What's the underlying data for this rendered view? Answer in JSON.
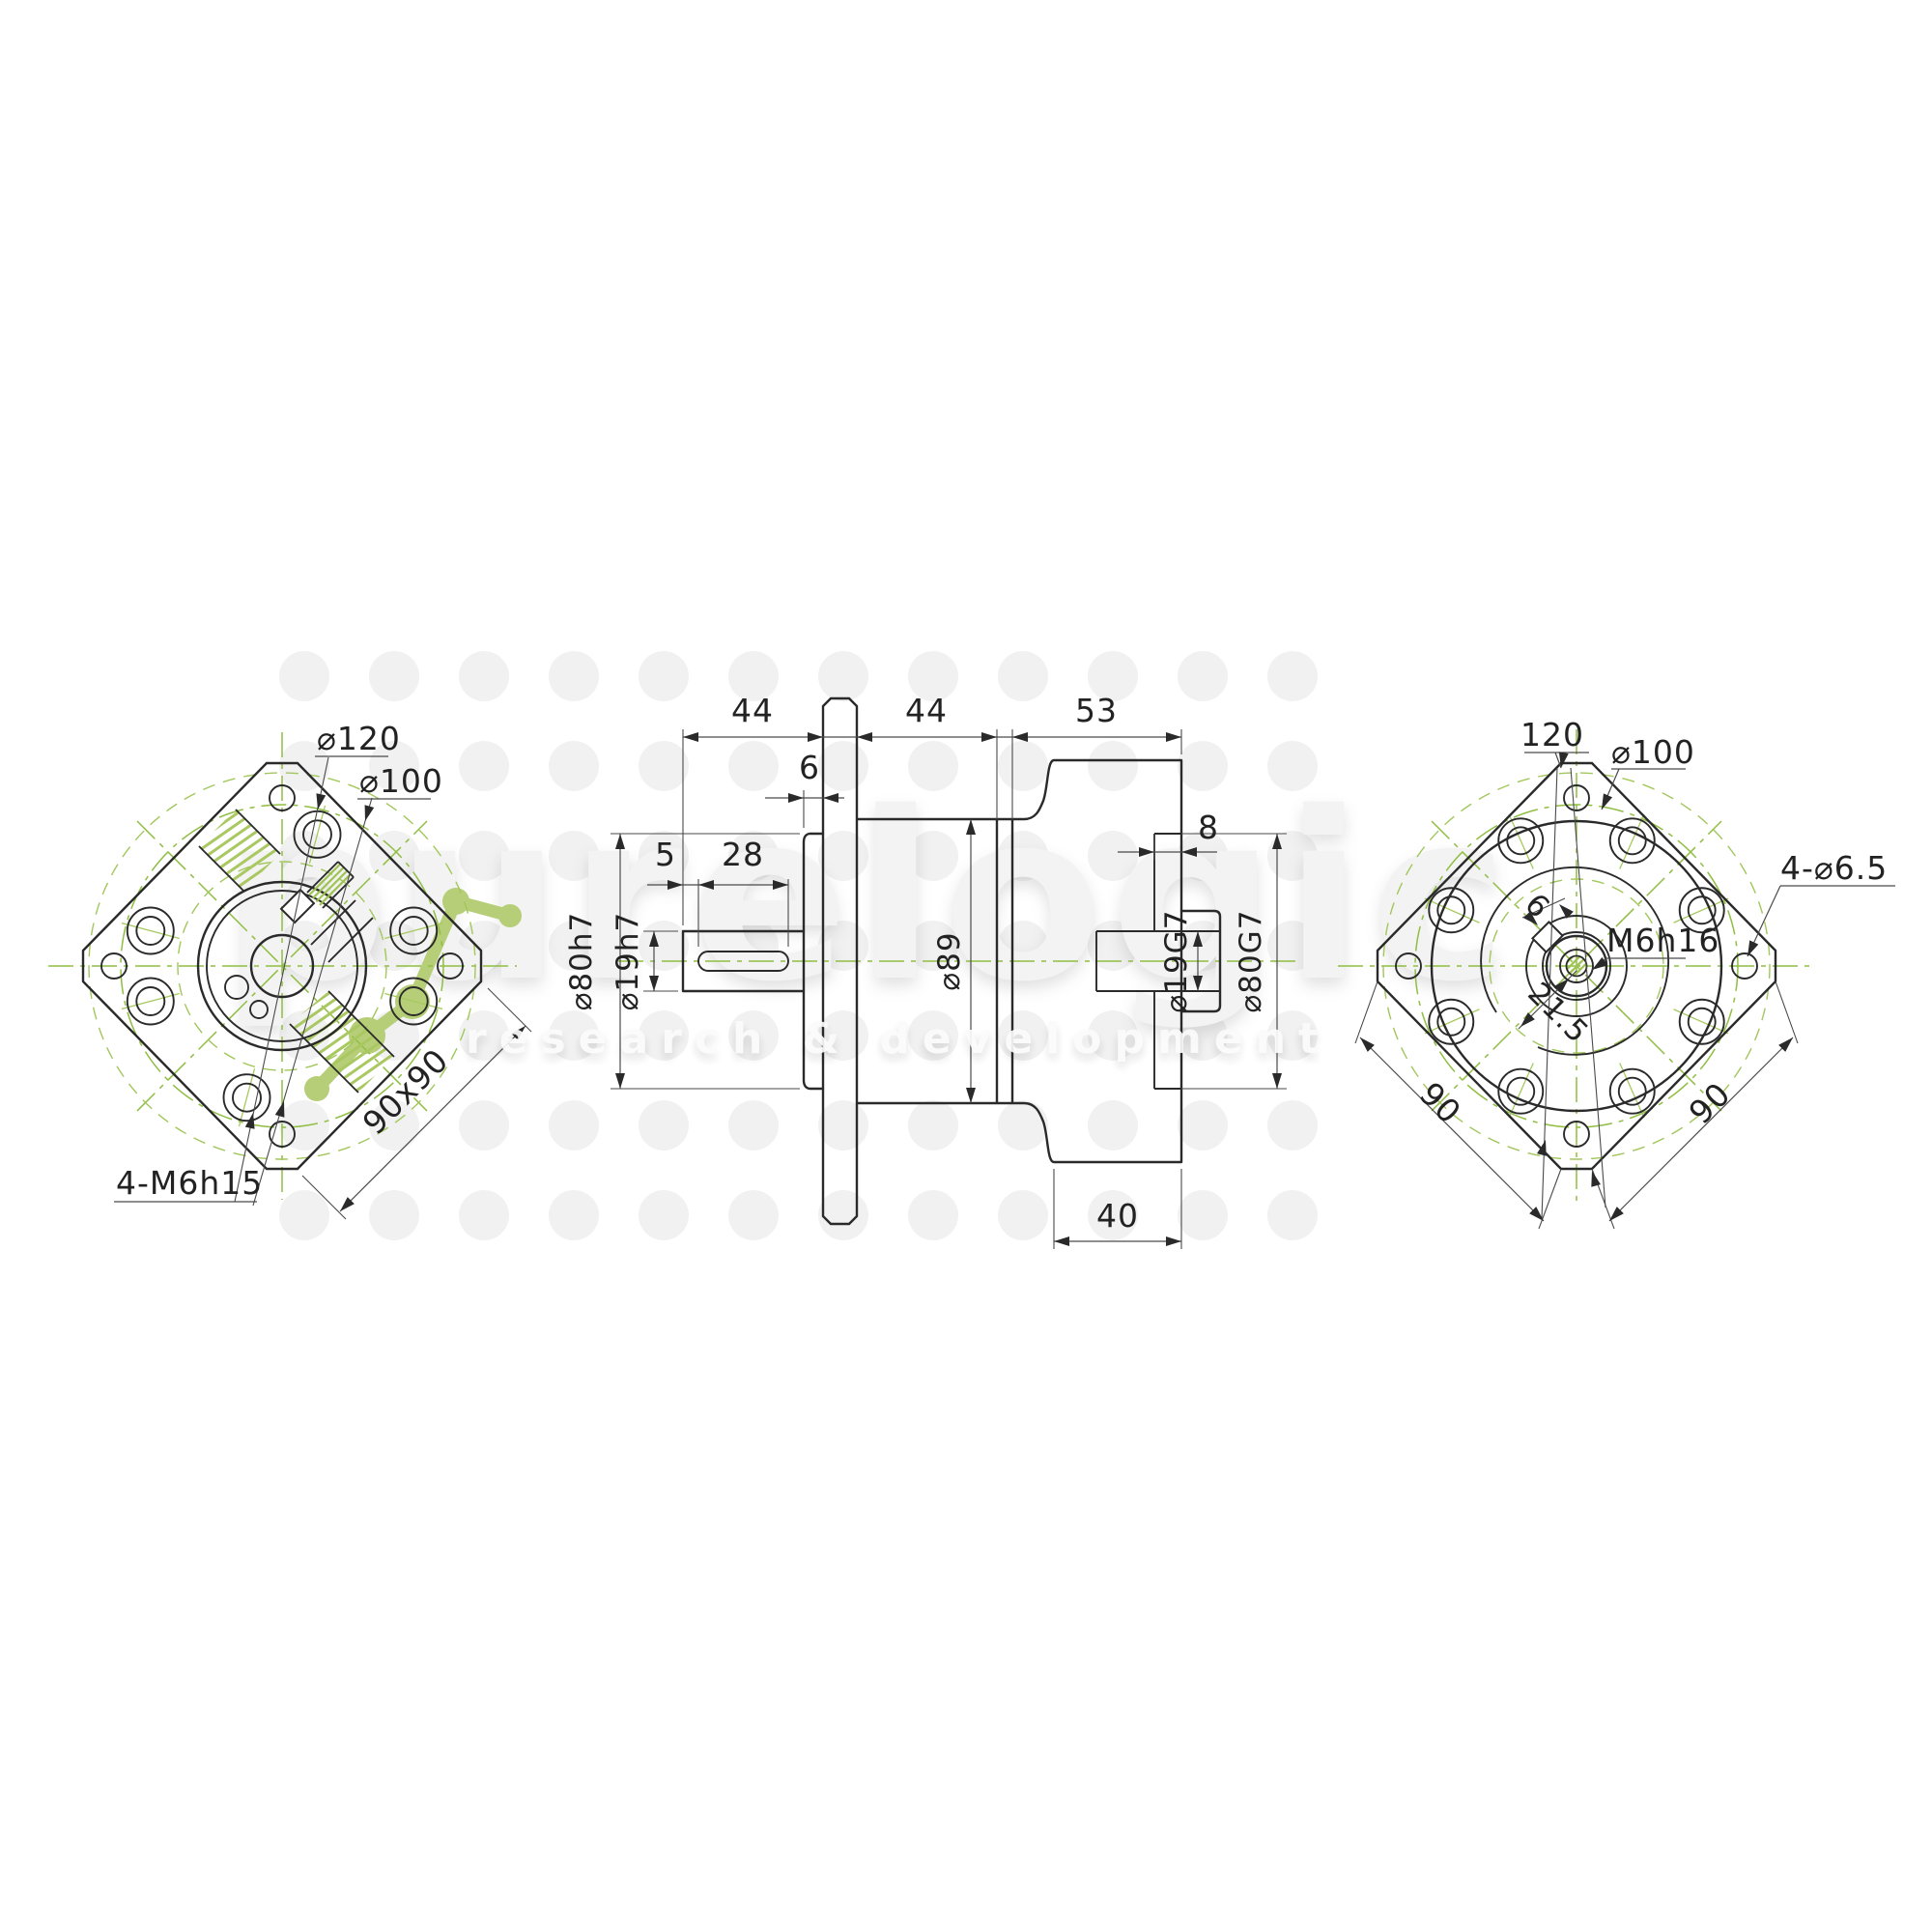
{
  "brand": {
    "name": "purelogic",
    "tagline": "research & development"
  },
  "colors": {
    "accent_green": "#b6ce77",
    "centerline_green": "#8fbe42",
    "line_dark": "#2a2a2a"
  },
  "front_view": {
    "dim_bolt_circle_120": "⌀120",
    "dim_bolt_circle_100": "⌀100",
    "dim_square": "90x90",
    "dim_tapped_holes": "4-M6h15"
  },
  "side_view": {
    "dim_input_shaft_length": "44",
    "dim_body_length": "44",
    "dim_bell_length": "53",
    "dim_pilot_depth": "6",
    "dim_keyway_offset": "5",
    "dim_keyway_length": "28",
    "dim_recess_depth": "8",
    "dim_output_hub_length": "40",
    "dim_pilot_diameter": "⌀80h7",
    "dim_shaft_diameter": "⌀19h7",
    "dim_body_diameter": "⌀89",
    "dim_output_bore_diameter": "⌀19G7",
    "dim_recess_diameter": "⌀80G7"
  },
  "output_view": {
    "dim_flange_width": "120",
    "dim_bolt_circle_100": "⌀100",
    "dim_mount_holes": "4-⌀6.5",
    "dim_center_thread": "M6h16",
    "dim_keyway_width": "6",
    "dim_keyway_offset": "21.5",
    "dim_side_left": "90",
    "dim_side_right": "90"
  }
}
